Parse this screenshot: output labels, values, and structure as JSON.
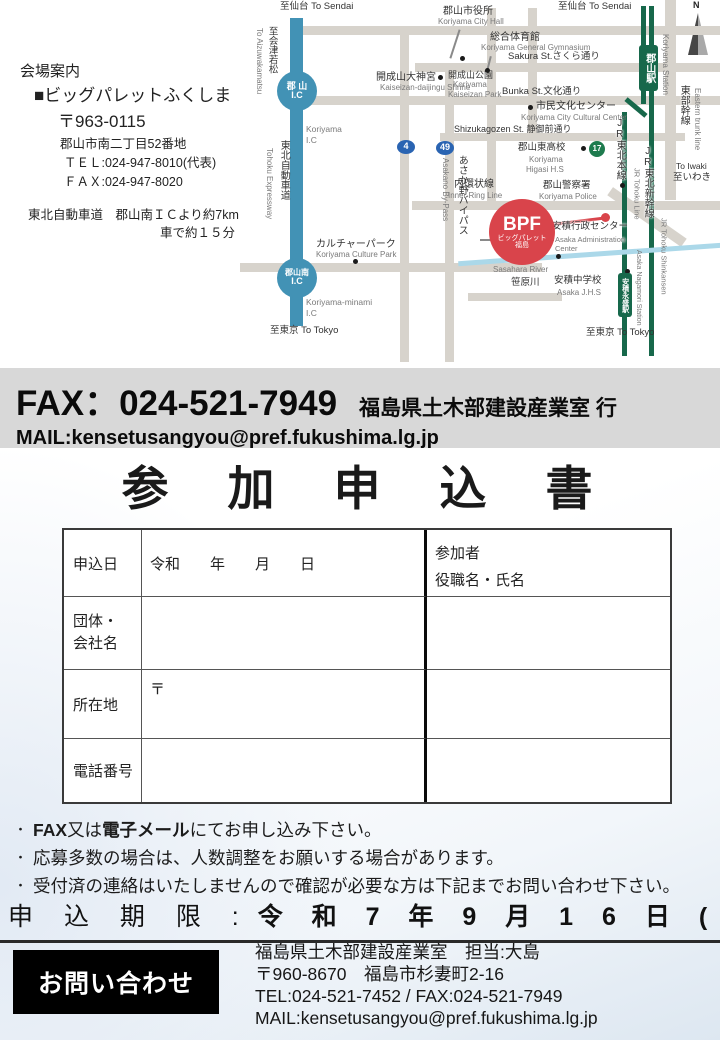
{
  "venue": {
    "heading": "会場案内",
    "name": "■ビッグパレットふくしま",
    "postal": "〒963-0115",
    "address": "郡山市南二丁目52番地",
    "tel": "ＴＥＬ:024-947-8010(代表)",
    "fax": "ＦＡＸ:024-947-8020",
    "access1": "東北自動車道　郡山南ＩＣより約7km",
    "access2": "車で約１５分"
  },
  "fax_band": {
    "fax_line": "FAX：024-521-7949",
    "recipient": "福島県土木部建設産業室 行",
    "mail_line": "MAIL:kensetusangyou@pref.fukushima.lg.jp",
    "background": "#d8d8d8"
  },
  "form": {
    "title": "参　加　申　込　書",
    "apply_date_label": "申込日",
    "apply_date_value": "令和　　年　　月　　日",
    "participants_line1": "参加者",
    "participants_line2": "役職名・氏名",
    "org_label_line1": "団体・",
    "org_label_line2": "会社名",
    "address_label": "所在地",
    "postal_mark": "〒",
    "phone_label": "電話番号"
  },
  "notes": {
    "items": [
      [
        {
          "t": "FAX",
          "b": true
        },
        {
          "t": "又は",
          "b": false
        },
        {
          "t": "電子メール",
          "b": true
        },
        {
          "t": "にてお申し込み下さい。",
          "b": false
        }
      ],
      [
        {
          "t": "応募多数の場合は、人数調整をお願いする場合があります。",
          "b": false
        }
      ],
      [
        {
          "t": "受付済の連絡はいたしませんので確認が必要な方は下記までお問い合わせ下さい。",
          "b": false
        }
      ]
    ]
  },
  "deadline": {
    "label": "申 込 期 限 :",
    "value": "令 和 7 年 9 月 1 6 日 ( 火 )"
  },
  "contact": {
    "box_label": "お問い合わせ",
    "line1": "福島県土木部建設産業室　担当:大島",
    "line2": "〒960-8670　福島市杉妻町2-16",
    "line3": "TEL:024-521-7452 / FAX:024-521-7949",
    "line4": "MAIL:kensetusangyou@pref.fukushima.lg.jp"
  },
  "map": {
    "colors": {
      "road": "#d7d3cc",
      "rail": "#17684b",
      "expy": "#4292b5",
      "river": "#abd8e9",
      "leader": "#8a8a8a",
      "red": "#d9444b",
      "blue": "#2a64b2",
      "green17": "#1e7b4e"
    },
    "bars": [
      {
        "n": "road-top",
        "x": 50,
        "y": 26,
        "w": 430,
        "h": 9,
        "c": "road"
      },
      {
        "n": "road-sakura-st",
        "x": 175,
        "y": 63,
        "w": 305,
        "h": 9,
        "c": "road"
      },
      {
        "n": "road-bunka-st",
        "x": 50,
        "y": 96,
        "w": 430,
        "h": 9,
        "c": "road"
      },
      {
        "n": "road-shizukagozen-st",
        "x": 200,
        "y": 133,
        "w": 245,
        "h": 8,
        "c": "road"
      },
      {
        "n": "road-inner-ring",
        "x": 172,
        "y": 201,
        "w": 308,
        "h": 9,
        "c": "road"
      },
      {
        "n": "road-minami",
        "x": 0,
        "y": 263,
        "w": 302,
        "h": 9,
        "c": "road"
      },
      {
        "n": "road-south-spur",
        "x": 228,
        "y": 293,
        "w": 94,
        "h": 8,
        "c": "road"
      },
      {
        "n": "road-route4",
        "x": 160,
        "y": 26,
        "w": 9,
        "h": 336,
        "c": "road"
      },
      {
        "n": "road-asakano-bypass",
        "x": 205,
        "y": 63,
        "w": 9,
        "h": 299,
        "c": "road"
      },
      {
        "n": "road-station-west",
        "x": 247,
        "y": 8,
        "w": 9,
        "h": 202,
        "c": "road"
      },
      {
        "n": "road-center",
        "x": 288,
        "y": 8,
        "w": 9,
        "h": 130,
        "c": "road"
      },
      {
        "n": "road-eastern-trunk",
        "x": 425,
        "y": 0,
        "w": 11,
        "h": 200,
        "c": "road"
      },
      {
        "n": "road-eastern-trunk-diagonal",
        "x": 362,
        "y": 212,
        "w": 90,
        "h": 10,
        "c": "road",
        "r": 35
      },
      {
        "n": "tohoku-expressway",
        "x": 50,
        "y": 18,
        "w": 13,
        "h": 308,
        "c": "expy"
      },
      {
        "n": "rail-shinkansen",
        "x": 409,
        "y": 6,
        "w": 5,
        "h": 350,
        "c": "rail"
      },
      {
        "n": "rail-tohoku-top",
        "x": 401,
        "y": 6,
        "w": 5,
        "h": 98,
        "c": "rail"
      },
      {
        "n": "rail-tohoku-jog",
        "x": 383,
        "y": 105,
        "w": 26,
        "h": 5,
        "c": "rail",
        "r": 40
      },
      {
        "n": "rail-tohoku-main",
        "x": 382,
        "y": 112,
        "w": 5,
        "h": 244,
        "c": "rail"
      },
      {
        "n": "sasahara-river-line",
        "x": 218,
        "y": 252,
        "w": 264,
        "h": 5,
        "c": "river",
        "r": -4
      },
      {
        "n": "leader-city-hall",
        "x": 214,
        "y": 29,
        "w": 2,
        "h": 30,
        "c": "leader",
        "r": 18
      },
      {
        "n": "leader-gymnasium",
        "x": 248,
        "y": 56,
        "w": 2,
        "h": 15,
        "c": "leader",
        "r": 14
      },
      {
        "n": "leader-admin-center",
        "x": 240,
        "y": 239,
        "w": 74,
        "h": 2,
        "c": "leader"
      },
      {
        "n": "leader-bpf",
        "x": 308,
        "y": 220,
        "w": 57,
        "h": 3,
        "c": "red",
        "r": -7
      }
    ],
    "labels": [
      {
        "t": "至仙台 To Sendai",
        "x": 40,
        "y": 2,
        "s": 9.5
      },
      {
        "t": "至仙台 To Sendai",
        "x": 318,
        "y": 2,
        "s": 9.5
      },
      {
        "t": "至会津若松",
        "x": 26,
        "y": 26,
        "s": 9.5,
        "v": 1
      },
      {
        "t": "To Aizuwakamatsu",
        "x": 14,
        "y": 28,
        "s": 8,
        "c": "g",
        "v": 2
      },
      {
        "t": "Koriyama",
        "x": 66,
        "y": 125,
        "s": 8.5,
        "c": "g"
      },
      {
        "t": "I.C",
        "x": 66,
        "y": 136,
        "s": 8.5,
        "c": "g"
      },
      {
        "t": "東北自動車道",
        "x": 38,
        "y": 140,
        "s": 10,
        "v": 1
      },
      {
        "t": "Tohoku Expressway",
        "x": 24,
        "y": 148,
        "s": 8,
        "c": "g",
        "v": 2
      },
      {
        "t": "郡山市役所",
        "x": 203,
        "y": 6,
        "s": 10
      },
      {
        "t": "Koriyama City Hall",
        "x": 198,
        "y": 18,
        "s": 8,
        "c": "g"
      },
      {
        "t": "総合体育館",
        "x": 250,
        "y": 32,
        "s": 10
      },
      {
        "t": "Koriyama General Gymnasium",
        "x": 241,
        "y": 44,
        "s": 8,
        "c": "g"
      },
      {
        "t": "Sakura St.さくら通り",
        "x": 268,
        "y": 52,
        "s": 9.5
      },
      {
        "t": "開成山大神宮",
        "x": 136,
        "y": 72,
        "s": 10
      },
      {
        "t": "Kaiseizan-daijingu Shrine",
        "x": 140,
        "y": 84,
        "s": 8,
        "c": "g"
      },
      {
        "t": "開成山公園",
        "x": 208,
        "y": 70,
        "s": 9
      },
      {
        "t": "Koriyama",
        "x": 213,
        "y": 81,
        "s": 8,
        "c": "g"
      },
      {
        "t": "Kaiseizan Park",
        "x": 208,
        "y": 91,
        "s": 8,
        "c": "g"
      },
      {
        "t": "Bunka St.文化通り",
        "x": 262,
        "y": 87,
        "s": 9.5
      },
      {
        "t": "市民文化センター",
        "x": 296,
        "y": 101,
        "s": 10
      },
      {
        "t": "Koriyama City Cultural Center",
        "x": 281,
        "y": 114,
        "s": 8,
        "c": "g"
      },
      {
        "t": "Shizukagozen St. 静御前通り",
        "x": 214,
        "y": 124,
        "s": 9
      },
      {
        "t": "郡山東高校",
        "x": 278,
        "y": 143,
        "s": 9.5
      },
      {
        "t": "Koriyama",
        "x": 289,
        "y": 156,
        "s": 8,
        "c": "g"
      },
      {
        "t": "Higasi H.S",
        "x": 286,
        "y": 166,
        "s": 8,
        "c": "g"
      },
      {
        "t": "あさか野バイパス",
        "x": 216,
        "y": 155,
        "s": 10,
        "v": 1
      },
      {
        "t": "Asakano By-Pass",
        "x": 200,
        "y": 158,
        "s": 8,
        "c": "g",
        "v": 2
      },
      {
        "t": "内環状線",
        "x": 214,
        "y": 179,
        "s": 10
      },
      {
        "t": "Inner Ring Line",
        "x": 208,
        "y": 192,
        "s": 8,
        "c": "g"
      },
      {
        "t": "郡山警察署",
        "x": 303,
        "y": 181,
        "s": 9.5
      },
      {
        "t": "Koriyama Police",
        "x": 299,
        "y": 193,
        "s": 8,
        "c": "g"
      },
      {
        "t": "カルチャーパーク",
        "x": 76,
        "y": 239,
        "s": 10
      },
      {
        "t": "Koriyama Culture Park",
        "x": 76,
        "y": 251,
        "s": 8,
        "c": "g"
      },
      {
        "t": "Koriyama-minami",
        "x": 66,
        "y": 298,
        "s": 8.5,
        "c": "g"
      },
      {
        "t": "I.C",
        "x": 66,
        "y": 309,
        "s": 8.5,
        "c": "g"
      },
      {
        "t": "安積行政センター",
        "x": 312,
        "y": 222,
        "s": 9.5,
        "halo": 1
      },
      {
        "t": "Asaka Administration",
        "x": 315,
        "y": 236,
        "s": 7.5,
        "c": "g",
        "halo": 1
      },
      {
        "t": "Center",
        "x": 315,
        "y": 245,
        "s": 7.5,
        "c": "g",
        "halo": 1
      },
      {
        "t": "Sasahara River",
        "x": 253,
        "y": 266,
        "s": 8,
        "c": "g"
      },
      {
        "t": "笹原川",
        "x": 271,
        "y": 278,
        "s": 9.5
      },
      {
        "t": "安積中学校",
        "x": 314,
        "y": 276,
        "s": 9.5,
        "halo": 1
      },
      {
        "t": "Asaka J.H.S",
        "x": 317,
        "y": 289,
        "s": 8,
        "c": "g"
      },
      {
        "t": "至東京 To Tokyo",
        "x": 30,
        "y": 326,
        "s": 9.5
      },
      {
        "t": "至東京 To Tokyo",
        "x": 346,
        "y": 328,
        "s": 9.5
      },
      {
        "t": "Koriyama Station",
        "x": 420,
        "y": 34,
        "s": 8,
        "c": "g",
        "v": 3
      },
      {
        "t": "東部幹線",
        "x": 438,
        "y": 85,
        "s": 10,
        "v": 1,
        "halo": 1
      },
      {
        "t": "Eastern trunk line",
        "x": 452,
        "y": 88,
        "s": 8,
        "c": "g",
        "v": 2
      },
      {
        "t": "To Iwaki",
        "x": 436,
        "y": 162,
        "s": 8.5
      },
      {
        "t": "至いわき",
        "x": 433,
        "y": 173,
        "s": 9.5
      },
      {
        "t": "JR東北本線",
        "x": 374,
        "y": 118,
        "s": 10,
        "v": 1,
        "halo": 1
      },
      {
        "t": "JR Tohoku Line",
        "x": 392,
        "y": 168,
        "s": 7.5,
        "c": "g",
        "v": 3
      },
      {
        "t": "JR東北新幹線",
        "x": 402,
        "y": 146,
        "s": 10,
        "v": 1,
        "halo": 1
      },
      {
        "t": "JR Tohoku Shinkansen",
        "x": 419,
        "y": 218,
        "s": 7.5,
        "c": "g",
        "v": 3
      },
      {
        "t": "Asaka Nagamori Station",
        "x": 394,
        "y": 250,
        "s": 7,
        "c": "g",
        "v": 3
      }
    ],
    "dots": [
      {
        "x": 220,
        "y": 56,
        "d": 5
      },
      {
        "x": 245,
        "y": 68,
        "d": 5
      },
      {
        "x": 198,
        "y": 75,
        "d": 5
      },
      {
        "x": 288,
        "y": 105,
        "d": 5
      },
      {
        "x": 341,
        "y": 146,
        "d": 5
      },
      {
        "x": 380,
        "y": 183,
        "d": 5
      },
      {
        "x": 316,
        "y": 254,
        "d": 5
      },
      {
        "x": 385,
        "y": 269,
        "d": 5
      },
      {
        "x": 113,
        "y": 259,
        "d": 5
      },
      {
        "x": 361,
        "y": 213,
        "d": 9,
        "c": "#d9444b"
      }
    ],
    "badges": [
      {
        "n": "koriyama-ic-badge",
        "kind": "circle",
        "x": 37,
        "y": 71,
        "w": 40,
        "h": 40,
        "bg": "expy",
        "lines": [
          {
            "t": "郡 山",
            "s": 9,
            "b": 1
          },
          {
            "t": "I.C",
            "s": 9,
            "b": 1
          }
        ]
      },
      {
        "n": "koriyama-minami-ic-badge",
        "kind": "circle",
        "x": 37,
        "y": 258,
        "w": 40,
        "h": 40,
        "bg": "expy",
        "lines": [
          {
            "t": "郡山南",
            "s": 8,
            "b": 1
          },
          {
            "t": "I.C",
            "s": 9,
            "b": 1
          }
        ]
      },
      {
        "n": "koriyama-station-badge",
        "kind": "rectv",
        "x": 399,
        "y": 45,
        "w": 19,
        "h": 46,
        "bg": "rail",
        "lines": [
          {
            "t": "郡山駅",
            "s": 10,
            "b": 1
          }
        ]
      },
      {
        "n": "asaka-nagamori-station-badge",
        "kind": "rectv",
        "x": 378,
        "y": 273,
        "w": 14,
        "h": 44,
        "bg": "rail",
        "lines": [
          {
            "t": "安積永盛駅",
            "s": 7,
            "b": 1
          }
        ]
      },
      {
        "n": "bpf-badge",
        "kind": "circle",
        "x": 249,
        "y": 199,
        "w": 66,
        "h": 66,
        "bg": "red",
        "lines": [
          {
            "t": "BPF",
            "s": 19,
            "b": 1
          },
          {
            "t": "ビッグパレット",
            "s": 7
          },
          {
            "t": "福島",
            "s": 7
          }
        ]
      },
      {
        "n": "route4-shield",
        "kind": "ellipse",
        "x": 157,
        "y": 140,
        "w": 18,
        "h": 14,
        "bg": "blue",
        "lines": [
          {
            "t": "4",
            "s": 9,
            "b": 1
          }
        ]
      },
      {
        "n": "route49-shield",
        "kind": "ellipse",
        "x": 196,
        "y": 141,
        "w": 18,
        "h": 14,
        "bg": "blue",
        "lines": [
          {
            "t": "49",
            "s": 9,
            "b": 1
          }
        ]
      },
      {
        "n": "route17-shield",
        "kind": "circle",
        "x": 349,
        "y": 141,
        "w": 16,
        "h": 16,
        "bg": "green17",
        "lines": [
          {
            "t": "17",
            "s": 8,
            "b": 1
          }
        ]
      }
    ]
  }
}
